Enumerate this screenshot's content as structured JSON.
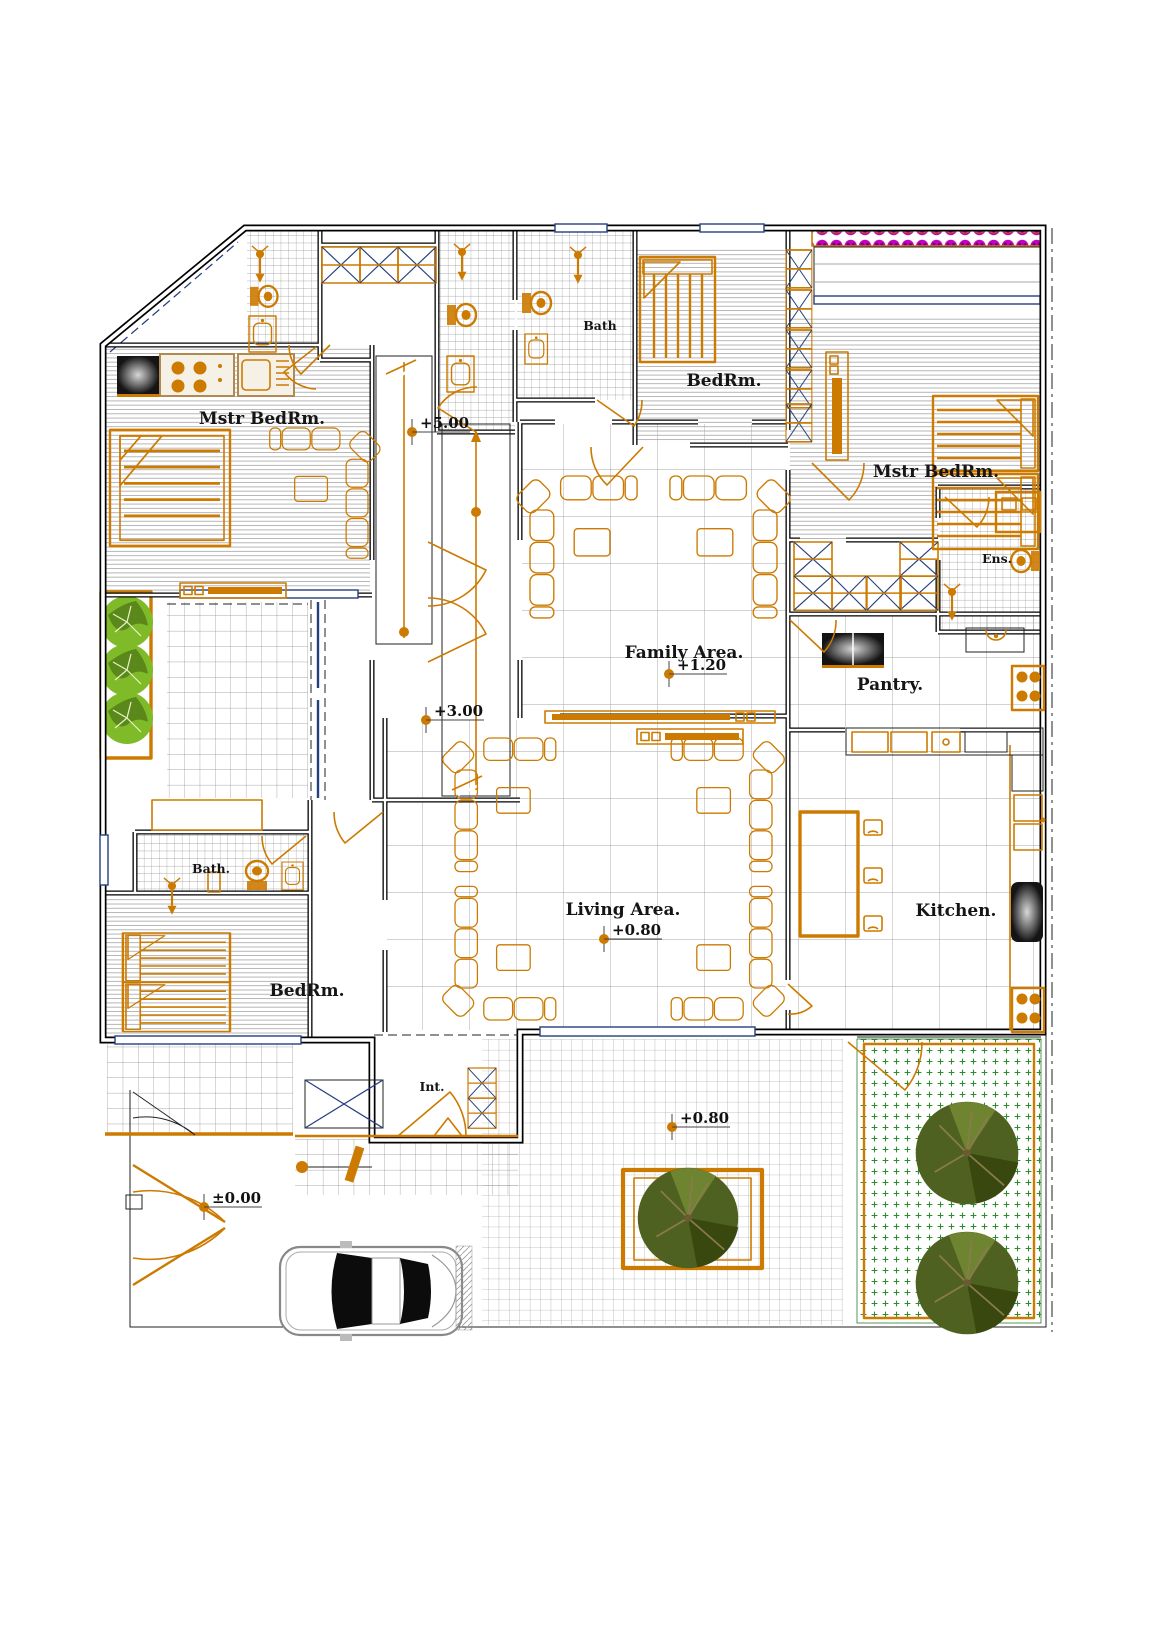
{
  "plan": {
    "rooms": {
      "mstr_bedrm_left": "Mstr BedRm.",
      "bath_top": "Bath",
      "bedrm_top": "BedRm.",
      "mstr_bedrm_right": "Mstr BedRm.",
      "ensuite": "Ens.",
      "pantry": "Pantry.",
      "family_area": "Family Area.",
      "living_area": "Living Area.",
      "kitchen": "Kitchen.",
      "bath_lower": "Bath.",
      "bedrm_lower": "BedRm.",
      "interior": "Int."
    },
    "elevations": {
      "upper_stairs": "+5.00",
      "mid_stairs": "+3.00",
      "family": "+1.20",
      "living": "+0.80",
      "terrace": "+0.80",
      "ground": "±0.00"
    },
    "colors": {
      "accent": "#CC7A00",
      "window_navy": "#24407E",
      "flower_magenta": "#C400C4",
      "tree_bright": "#7FBA28",
      "tree_bright_dark": "#557F18",
      "tree_dark": "#4F6120",
      "tree_dark_shade": "#39480F",
      "grass_green": "#2E8B2E",
      "tile_grey": "#8E8E8E",
      "hatch_grey": "#A5A5A5"
    }
  }
}
